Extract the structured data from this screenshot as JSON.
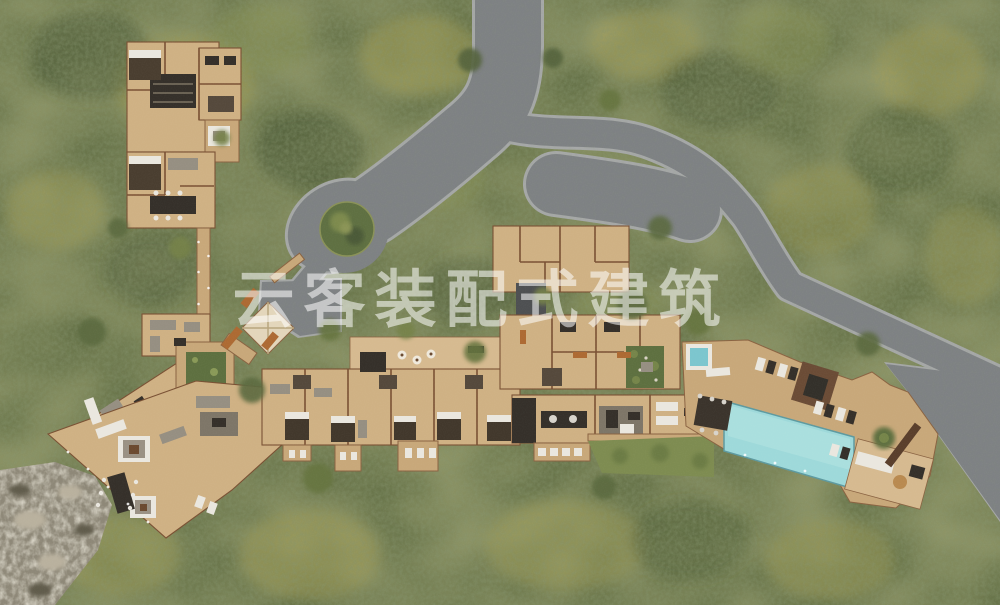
{
  "watermark": {
    "text": "云客装配式建筑",
    "color": "#ffffff",
    "opacity": 0.55
  },
  "scene": {
    "type": "architectural-site-plan-rendering",
    "description_regions": [
      "forest-background",
      "access-road",
      "road-fork",
      "roundabout",
      "roundabout-island",
      "entry-drive",
      "entry-canopy",
      "north-lodge",
      "connecting-walkway",
      "west-wing",
      "courtyard-garden-west",
      "southwest-wing",
      "fire-pit-feature",
      "guest-suites-row",
      "suites-upper-deck",
      "upper-plan-building",
      "second-row-rooms",
      "garden-courtyard",
      "main-lodge",
      "dining-kitchen",
      "lawn",
      "pool-deck",
      "swimming-pool",
      "hot-tub",
      "bar-pavilion",
      "sun-loungers",
      "spa-pavilion",
      "parking-area",
      "cliff-rocks"
    ]
  },
  "palette": {
    "forest_green": "#68744a",
    "forest_patch_yellow": "#a8a258",
    "forest_dark": "#3d4a2a",
    "road_gray": "#7e8184",
    "curb_gray": "#a6a8a8",
    "deck_tan": "#c8a87a",
    "floor_tan": "#cfb184",
    "wall_brown": "#7a5134",
    "pool_blue": "#9ed9da",
    "lawn_green": "#7e8c51",
    "island_green": "#5f7042",
    "rock_gray": "#8e8878",
    "terracotta": "#ad6a33",
    "canopy_cream": "#e3d6bb",
    "bar_brown": "#6b4c36"
  }
}
